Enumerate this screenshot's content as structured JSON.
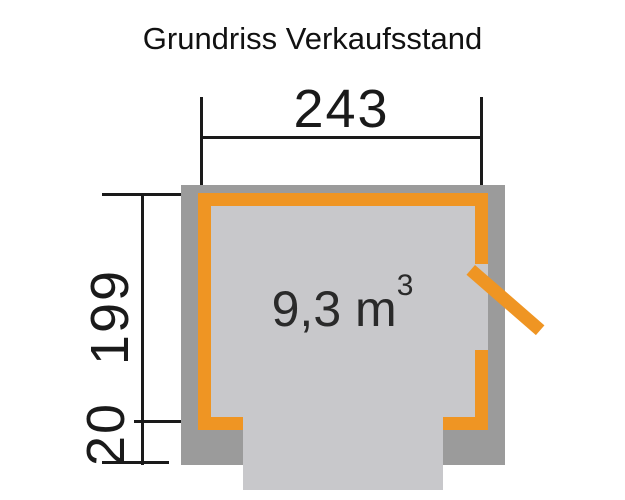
{
  "title": "Grundriss Verkaufsstand",
  "floorplan": {
    "width_dimension": "243",
    "depth_dimension": "199",
    "counter_depth_dimension": "20",
    "volume_text": "9,3 m",
    "volume_superscript": "3",
    "colors": {
      "wall_gray": "#9b9b9b",
      "floor_gray": "#c8c8cb",
      "accent_orange": "#ef9523",
      "line_black": "#1a1a1a"
    }
  }
}
